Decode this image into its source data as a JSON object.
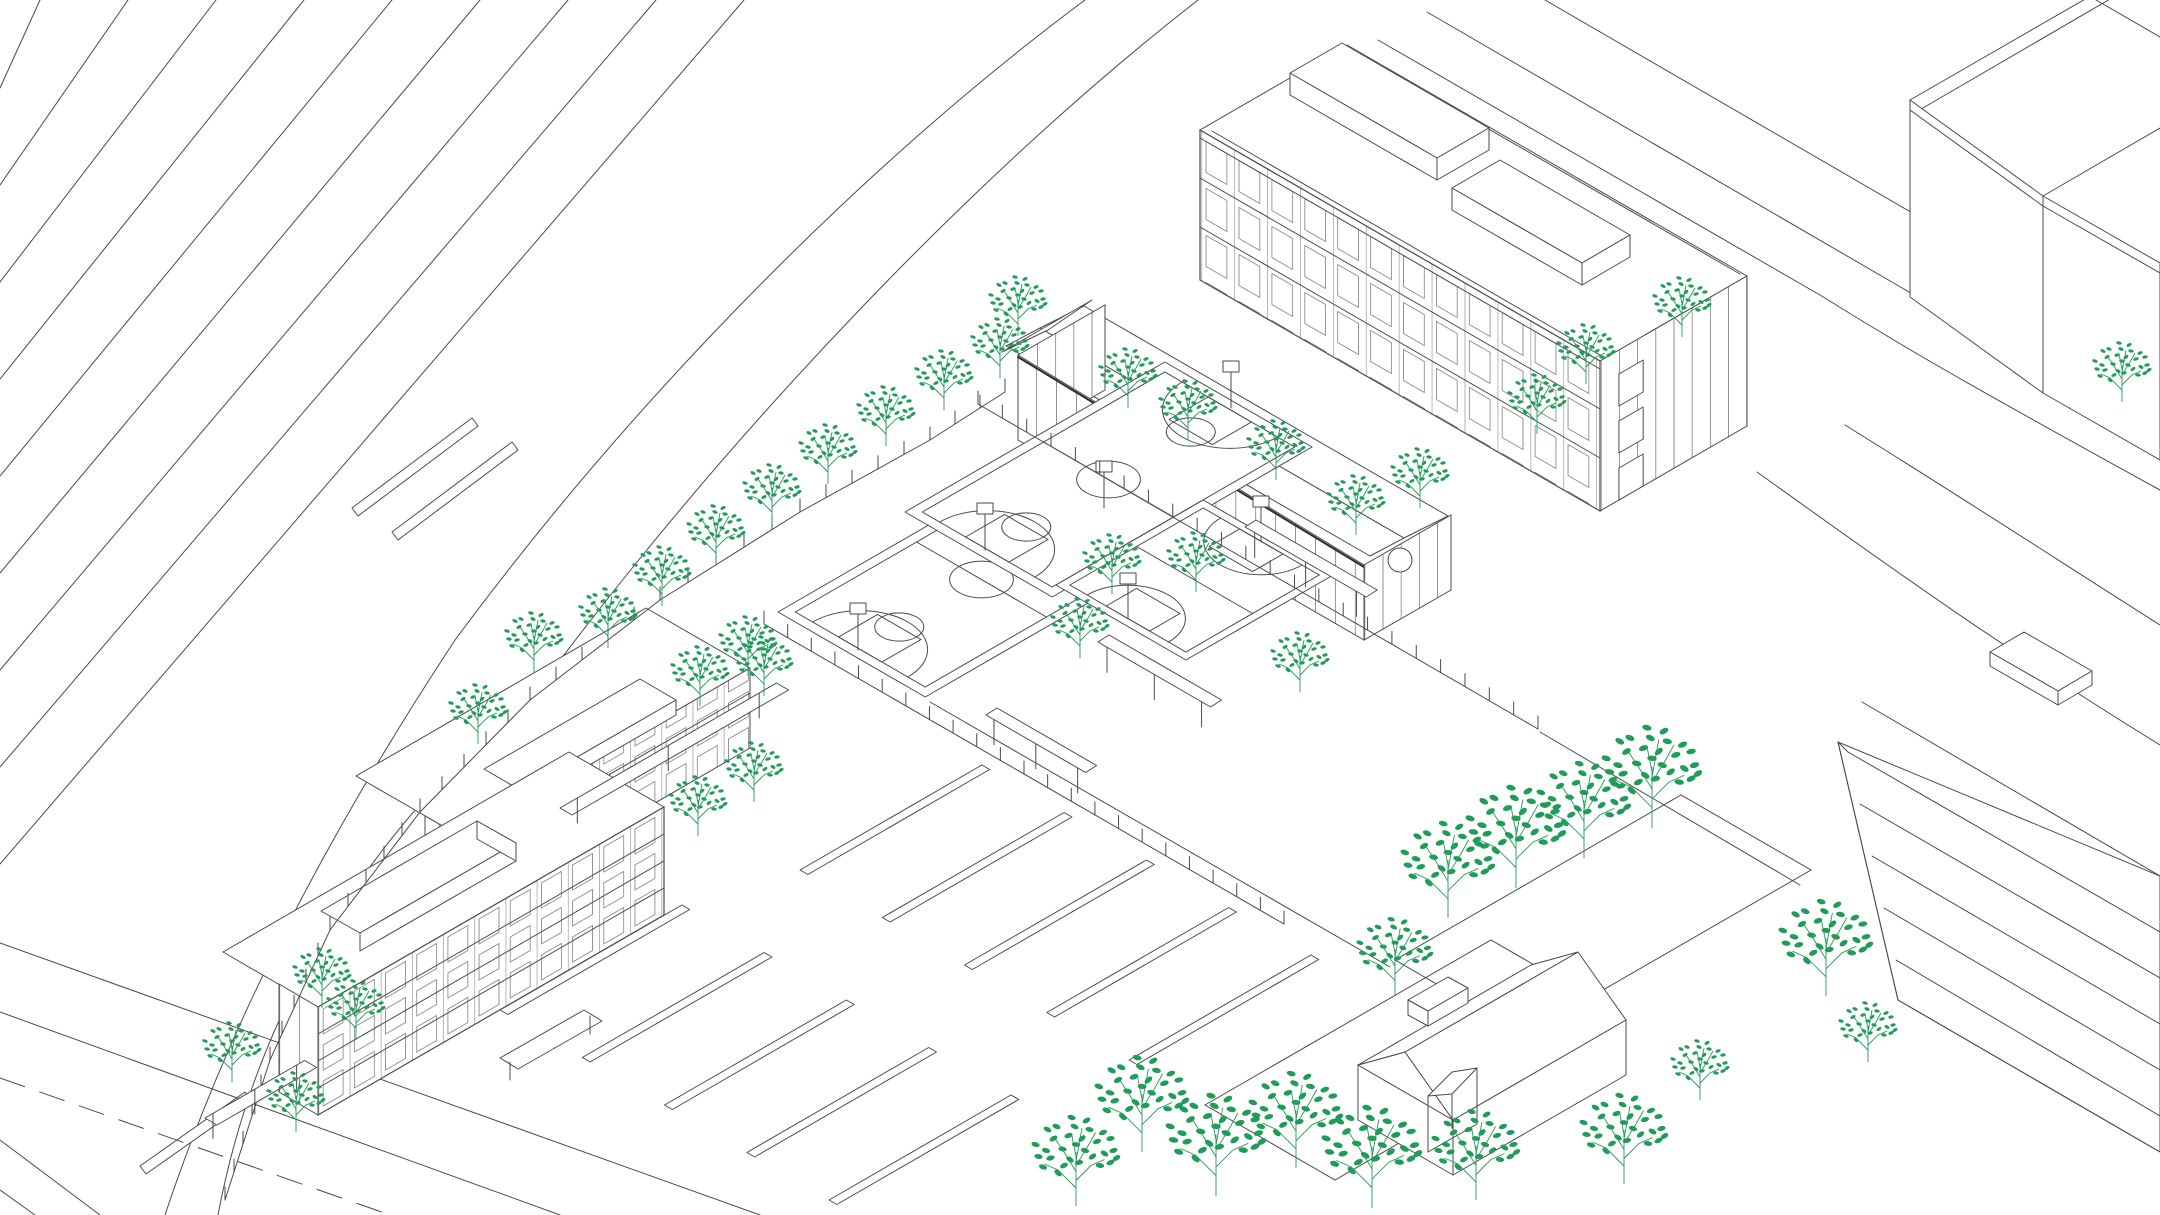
{
  "meta": {
    "drawing_kind": "axonometric architectural site plan, black line work on white with green trees",
    "visible_text": []
  },
  "palette": {
    "background": "#ffffff",
    "line": "#4a4a4a",
    "line_strong": "#2e2e2e",
    "line_light": "#9a9a9a",
    "tree": "#1f9c58"
  },
  "scene": {
    "railway_lines": [
      [
        0,
        88,
        40,
        0
      ],
      [
        0,
        185,
        128,
        0
      ],
      [
        0,
        282,
        216,
        0
      ],
      [
        0,
        379,
        304,
        0
      ],
      [
        0,
        476,
        392,
        0
      ],
      [
        0,
        573,
        480,
        0
      ],
      [
        0,
        670,
        568,
        0
      ],
      [
        0,
        767,
        656,
        0
      ],
      [
        0,
        864,
        744,
        0
      ],
      [
        0,
        1140,
        100,
        1215
      ],
      [
        0,
        1190,
        35,
        1215
      ],
      [
        2096,
        0,
        2160,
        37
      ]
    ],
    "boundary_curves": [
      "M165,1215 C230,1020 330,830 455,640 C640,390 870,160 1085,0",
      "M218,1215 C255,1020 350,850 545,680 C740,420 980,170 1198,0"
    ],
    "roads": [
      "M1427,12 L1897,285 C1985,336 2045,375 2160,440",
      "M1545,0 L1990,258 C2070,295 2110,318 2160,345",
      "M1378,40 L1820,295 C1900,345 1960,380 2160,490",
      "M1845,425 C1950,490 2050,555 2160,625",
      "M1757,472 C1880,560 1990,640 2160,745",
      "M0,1012 L560,1215",
      "M0,943 L760,1215",
      "M930,702 L1390,967",
      "M1540,732 L1800,885"
    ],
    "road_dashes": [
      "M0,1078 L390,1215"
    ],
    "lawns": [
      "M1395,960 L1681,795 L1811,870 L1525,1035 Z",
      "M1205,1105 L1491,940 L1621,1015 L1335,1180 Z"
    ],
    "platforms": [
      "M352,508 L472,418 L478,426 L358,516 Z",
      "M392,532 L512,442 L518,450 L398,540 Z",
      "M140,1166 L245,1092 L251,1100 L146,1174 Z"
    ],
    "fences": [
      {
        "pts": [
          [
            978,
            404
          ],
          [
            1538,
            729
          ]
        ],
        "gap": 27
      },
      {
        "pts": [
          [
            764,
            624
          ],
          [
            1284,
            924
          ]
        ],
        "gap": 27
      },
      {
        "pts": [
          [
            225,
            1200
          ],
          [
            270,
            1060
          ],
          [
            330,
            930
          ],
          [
            420,
            812
          ],
          [
            530,
            700
          ],
          [
            660,
            600
          ],
          [
            800,
            512
          ],
          [
            930,
            440
          ],
          [
            1005,
            392
          ]
        ],
        "gap": 28
      }
    ],
    "parking_banks": [
      {
        "ox": 500,
        "oy": 1010,
        "rows": 5,
        "len": 210,
        "gap": 95
      },
      {
        "ox": 800,
        "oy": 870,
        "rows": 5,
        "len": 210,
        "gap": 95
      }
    ],
    "benches": [
      {
        "x": 1245,
        "y": 527,
        "len": 140,
        "dir": "v",
        "legs": true
      },
      {
        "x": 1098,
        "y": 642,
        "len": 130,
        "dir": "v",
        "legs": true
      },
      {
        "x": 986,
        "y": 715,
        "len": 115,
        "dir": "v",
        "legs": true
      },
      {
        "x": 560,
        "y": 808,
        "len": 250,
        "dir": "u",
        "legs": true
      },
      {
        "x": 205,
        "y": 1118,
        "len": 115,
        "dir": "u",
        "legs": true
      }
    ],
    "trees": [
      {
        "x": 608,
        "y": 648,
        "s": 1
      },
      {
        "x": 662,
        "y": 606,
        "s": 1
      },
      {
        "x": 716,
        "y": 565,
        "s": 1
      },
      {
        "x": 772,
        "y": 524,
        "s": 1
      },
      {
        "x": 828,
        "y": 484,
        "s": 1
      },
      {
        "x": 886,
        "y": 446,
        "s": 1
      },
      {
        "x": 944,
        "y": 410,
        "s": 1
      },
      {
        "x": 1000,
        "y": 378,
        "s": 1
      },
      {
        "x": 700,
        "y": 706,
        "s": 1
      },
      {
        "x": 748,
        "y": 676,
        "s": 1
      },
      {
        "x": 1128,
        "y": 408,
        "s": 1
      },
      {
        "x": 1188,
        "y": 440,
        "s": 1
      },
      {
        "x": 1276,
        "y": 480,
        "s": 1
      },
      {
        "x": 1356,
        "y": 535,
        "s": 1
      },
      {
        "x": 1420,
        "y": 508,
        "s": 1
      },
      {
        "x": 1112,
        "y": 594,
        "s": 1
      },
      {
        "x": 1196,
        "y": 592,
        "s": 1
      },
      {
        "x": 1080,
        "y": 658,
        "s": 1
      },
      {
        "x": 1300,
        "y": 692,
        "s": 1
      },
      {
        "x": 1018,
        "y": 336,
        "s": 1
      },
      {
        "x": 1537,
        "y": 434,
        "s": 1
      },
      {
        "x": 1586,
        "y": 384,
        "s": 1
      },
      {
        "x": 1682,
        "y": 337,
        "s": 1
      },
      {
        "x": 534,
        "y": 672,
        "s": 1
      },
      {
        "x": 478,
        "y": 744,
        "s": 1
      },
      {
        "x": 764,
        "y": 696,
        "s": 1
      },
      {
        "x": 754,
        "y": 802,
        "s": 1
      },
      {
        "x": 698,
        "y": 836,
        "s": 1
      },
      {
        "x": 322,
        "y": 1008,
        "s": 1
      },
      {
        "x": 356,
        "y": 1040,
        "s": 1
      },
      {
        "x": 232,
        "y": 1082,
        "s": 1
      },
      {
        "x": 296,
        "y": 1132,
        "s": 1
      },
      {
        "x": 1448,
        "y": 918,
        "s": 1.6
      },
      {
        "x": 1516,
        "y": 888,
        "s": 1.7
      },
      {
        "x": 1584,
        "y": 858,
        "s": 1.6
      },
      {
        "x": 1652,
        "y": 828,
        "s": 1.7
      },
      {
        "x": 1826,
        "y": 996,
        "s": 1.6
      },
      {
        "x": 1868,
        "y": 1062,
        "s": 1
      },
      {
        "x": 1142,
        "y": 1152,
        "s": 1.6
      },
      {
        "x": 1216,
        "y": 1196,
        "s": 1.7
      },
      {
        "x": 1296,
        "y": 1168,
        "s": 1.6
      },
      {
        "x": 1372,
        "y": 1208,
        "s": 1.7
      },
      {
        "x": 1076,
        "y": 1206,
        "s": 1.5
      },
      {
        "x": 1395,
        "y": 996,
        "s": 1.3
      },
      {
        "x": 1476,
        "y": 1200,
        "s": 1.5
      },
      {
        "x": 1624,
        "y": 1184,
        "s": 1.5
      },
      {
        "x": 1700,
        "y": 1100,
        "s": 1
      },
      {
        "x": 2122,
        "y": 402,
        "s": 1
      }
    ]
  }
}
